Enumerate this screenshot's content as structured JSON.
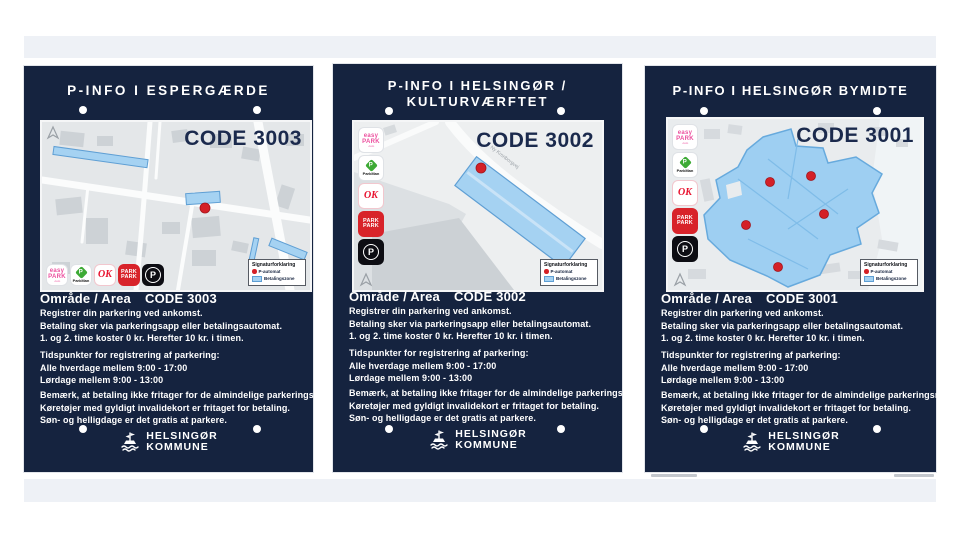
{
  "colors": {
    "sign_navy": "#15233f",
    "betalingszone_blue": "#a5d2f2",
    "p_automat_red": "#d42027"
  },
  "common": {
    "area_label": "Område / Area",
    "legend": {
      "title": "Signaturforklaring",
      "items": [
        {
          "label": "P-automat"
        },
        {
          "label": "Betalingszone"
        }
      ]
    },
    "paragraphs": [
      [
        "Registrer din parkering ved ankomst.",
        "Betaling sker via parkeringsapp eller betalingsautomat.",
        "1. og 2. time koster 0 kr. Herefter 10 kr. i timen."
      ],
      [
        "Tidspunkter for registrering af parkering:",
        "Alle hverdage mellem 9:00 - 17:00",
        "Lørdage mellem 9:00 - 13:00"
      ],
      [
        "Bemærk, at betaling ikke fritager for de almindelige parkeringsrestriktioner.",
        "Køretøjer med gyldigt invalidekort er fritaget for betaling.",
        "Søn- og helligdage er det gratis at parkere."
      ]
    ],
    "apps": [
      {
        "name": "EasyPark",
        "line1": "easy",
        "line2": "PARK",
        "suffix": ".com"
      },
      {
        "name": "ParkMan",
        "badge": "P",
        "label": "ParkMan"
      },
      {
        "name": "OK",
        "label": "OK"
      },
      {
        "name": "ParkPark",
        "line1": "PARK",
        "line2": "PARK"
      },
      {
        "name": "P-app",
        "label": "P"
      }
    ],
    "logo": {
      "line1": "HELSINGØR",
      "line2": "KOMMUNE"
    }
  },
  "signs": [
    {
      "title": "P-INFO I ESPERGÆRDE",
      "code": "CODE 3003",
      "area_code": "CODE 3003"
    },
    {
      "title": "P-INFO I HELSINGØR /",
      "title_line2": "KULTURVÆRFTET",
      "code": "CODE 3002",
      "area_code": "CODE 3002",
      "street_label": "Ny Kronborgvej"
    },
    {
      "title": "P-INFO I HELSINGØR BYMIDTE",
      "code": "CODE 3001",
      "area_code": "CODE 3001"
    }
  ]
}
